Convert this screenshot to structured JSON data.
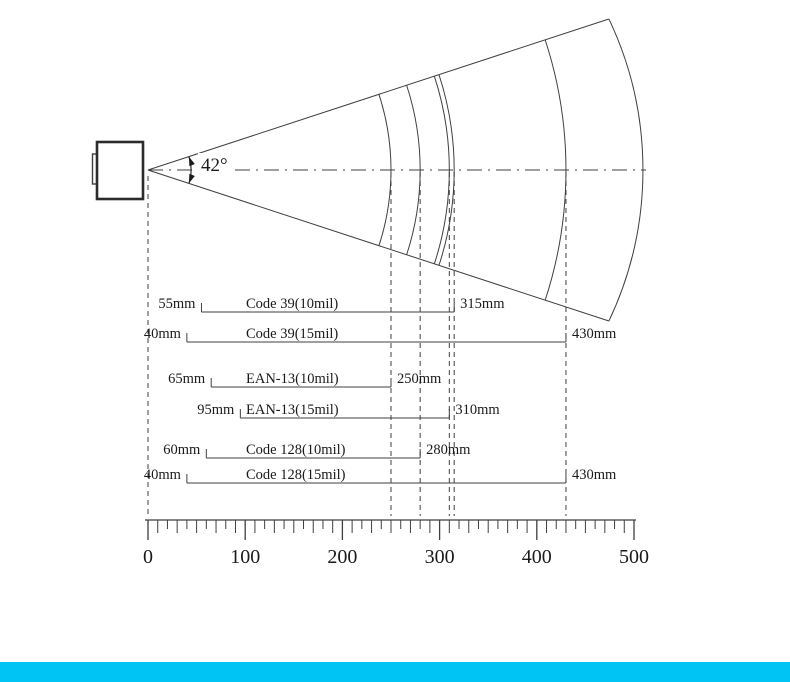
{
  "diagram": {
    "kind": "barcode-scanner-depth-of-field",
    "beam": {
      "angle_label": "42°"
    }
  },
  "bars": [
    {
      "code": "Code 39(10mil)",
      "near_label": "55mm",
      "far_label": "315mm",
      "near": 55,
      "far": 315
    },
    {
      "code": "Code 39(15mil)",
      "near_label": "40mm",
      "far_label": "430mm",
      "near": 40,
      "far": 430
    },
    {
      "code": "EAN-13(10mil)",
      "near_label": "65mm",
      "far_label": "250mm",
      "near": 65,
      "far": 250
    },
    {
      "code": "EAN-13(15mil)",
      "near_label": "95mm",
      "far_label": "310mm",
      "near": 95,
      "far": 310
    },
    {
      "code": "Code 128(10mil)",
      "near_label": "60mm",
      "far_label": "280mm",
      "near": 60,
      "far": 280
    },
    {
      "code": "Code 128(15mil)",
      "near_label": "40mm",
      "far_label": "430mm",
      "near": 40,
      "far": 430
    }
  ],
  "axis": {
    "min": 0,
    "max": 500,
    "major_step": 100,
    "minor_step": 10,
    "tick_labels": [
      "0",
      "100",
      "200",
      "300",
      "400",
      "500"
    ]
  },
  "colors": {
    "line": "#3f3f3f",
    "text": "#1a1a1a",
    "footer_accent": "#00c4f4"
  },
  "chart_data": {
    "type": "table",
    "title": "Barcode scanner depth of field, 42° beam",
    "units": "mm",
    "columns": [
      "symbology",
      "near_mm",
      "far_mm"
    ],
    "rows": [
      [
        "Code 39(10mil)",
        55,
        315
      ],
      [
        "Code 39(15mil)",
        40,
        430
      ],
      [
        "EAN-13(10mil)",
        65,
        250
      ],
      [
        "EAN-13(15mil)",
        95,
        310
      ],
      [
        "Code 128(10mil)",
        60,
        280
      ],
      [
        "Code 128(15mil)",
        40,
        430
      ]
    ],
    "axis_ticks": [
      0,
      100,
      200,
      300,
      400,
      500
    ]
  }
}
